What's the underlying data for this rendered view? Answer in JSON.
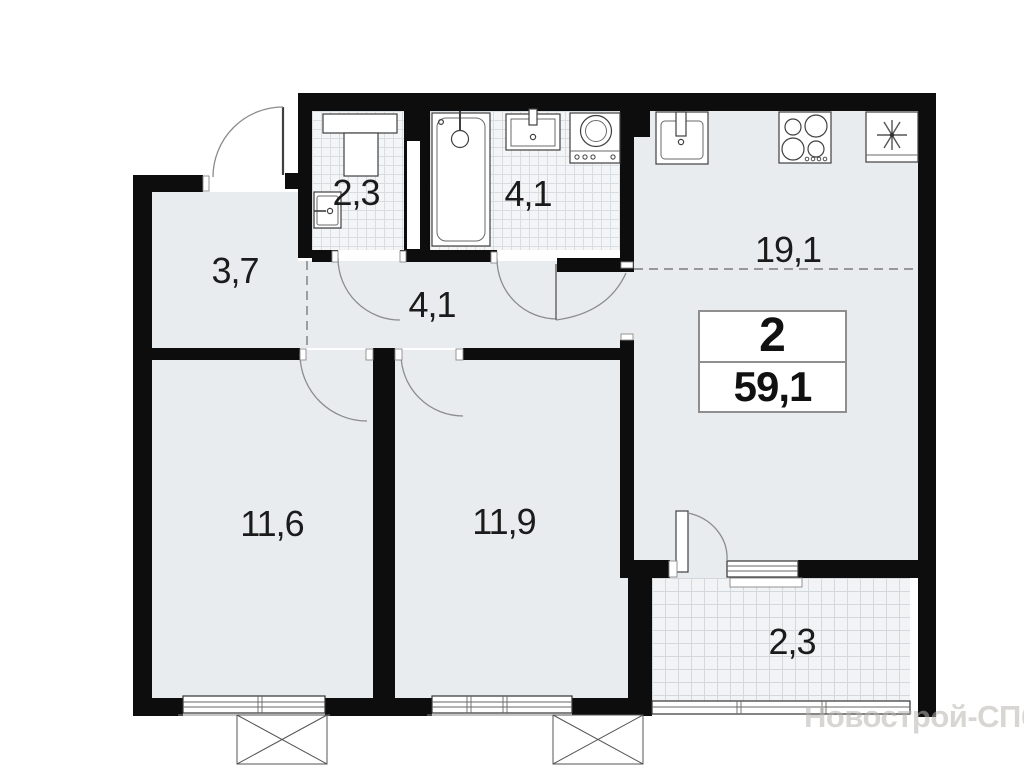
{
  "plan": {
    "watermark": "Новострой-СПб",
    "summary": {
      "rooms_count": "2",
      "total_area": "59,1"
    },
    "rooms": [
      {
        "id": "entry-hall",
        "area": "3,7"
      },
      {
        "id": "wc",
        "area": "2,3"
      },
      {
        "id": "bathroom",
        "area": "4,1"
      },
      {
        "id": "corridor",
        "area": "4,1"
      },
      {
        "id": "kitchen-living-room",
        "area": "19,1"
      },
      {
        "id": "bedroom-1",
        "area": "11,6"
      },
      {
        "id": "bedroom-2",
        "area": "11,9"
      },
      {
        "id": "balcony",
        "area": "2,3"
      }
    ],
    "icons": {
      "bathtub": "bathtub-icon",
      "wc_sink": "wc-sink-icon",
      "wc_counter": "counter-icon",
      "wc_washer": "washer-box-icon",
      "bath_sink": "bath-sink-icon",
      "washing_machine": "washing-machine-icon",
      "kitchen_sink": "kitchen-sink-icon",
      "stove": "stove-burners-icon",
      "fridge": "fridge-asterisk-icon",
      "ac_basket": "ac-basket-x-icon",
      "door": "door-swing-arc",
      "window": "window-glazing"
    },
    "colors": {
      "wall": "#0d0d0d",
      "floor": "#e8ecef",
      "tile_bg": "#f3f5f6",
      "tile_line": "#d8dde1",
      "label_text": "#1b1b1b",
      "info_border": "#8f8f8f",
      "watermark": "#b8b4ae"
    }
  }
}
